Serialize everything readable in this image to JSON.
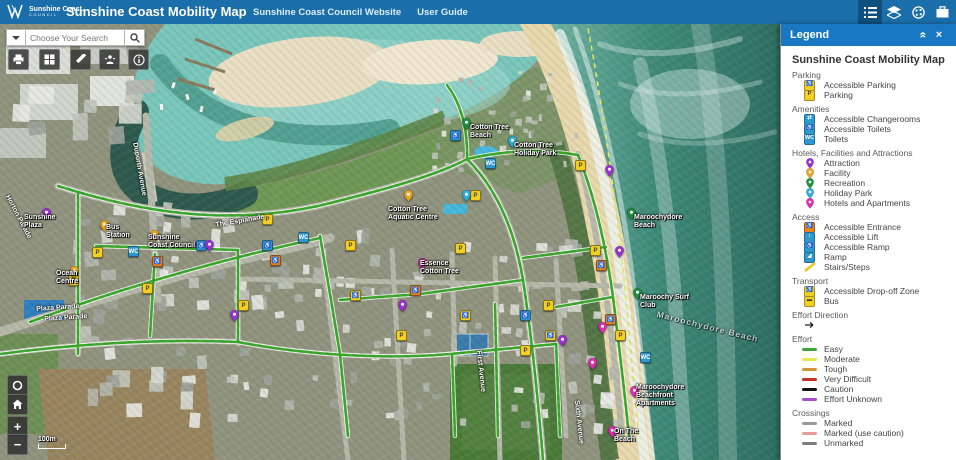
{
  "colors": {
    "header_bar": "#1a6ea9",
    "panel_header": "#1877c0",
    "path_green": "#3aa62b"
  },
  "header": {
    "logo": {
      "line1": "Sunshine Coast.",
      "line2": "COUNCIL"
    },
    "title": "Sunshine Coast Mobility Map",
    "links": [
      {
        "label": "Sunshine Coast Council Website"
      },
      {
        "label": "User Guide"
      }
    ],
    "tools": [
      {
        "name": "legend",
        "active": true
      },
      {
        "name": "layers",
        "active": false
      },
      {
        "name": "basemap",
        "active": false
      },
      {
        "name": "bookmarks",
        "active": false
      }
    ]
  },
  "search": {
    "placeholder": "Choose Your Search"
  },
  "map_tools": [
    {
      "name": "print"
    },
    {
      "name": "apps"
    },
    {
      "name": "draw"
    },
    {
      "name": "street-view"
    },
    {
      "name": "info"
    }
  ],
  "nav": {
    "zoom_in": "+",
    "zoom_out": "−",
    "scale_label": "100m"
  },
  "map": {
    "markers": [
      {
        "name": "parking-marker",
        "kind": "square",
        "color": "#f3cf1f",
        "glyph": "P",
        "glyph_color": "#3c3c3c",
        "points": [
          [
            68,
            251
          ],
          [
            92,
            223
          ],
          [
            142,
            259
          ],
          [
            238,
            276
          ],
          [
            262,
            190
          ],
          [
            345,
            216
          ],
          [
            396,
            306
          ],
          [
            455,
            219
          ],
          [
            470,
            166
          ],
          [
            520,
            321
          ],
          [
            543,
            276
          ],
          [
            575,
            136
          ],
          [
            590,
            221
          ],
          [
            615,
            306
          ]
        ]
      },
      {
        "name": "accessible-parking-marker",
        "kind": "square",
        "color": "#f3cf1f",
        "glyph": "♿",
        "glyph_color": "#1a4f9c",
        "points": [
          [
            350,
            266
          ],
          [
            460,
            286
          ],
          [
            545,
            306
          ]
        ]
      },
      {
        "name": "toilets-marker",
        "kind": "square",
        "color": "#2b98cf",
        "glyph": "WC",
        "glyph_color": "#ffffff",
        "points": [
          [
            128,
            222
          ],
          [
            298,
            208
          ],
          [
            485,
            134
          ],
          [
            640,
            328
          ]
        ]
      },
      {
        "name": "accessible-toilets-marker",
        "kind": "square",
        "color": "#2b98cf",
        "glyph": "♿",
        "glyph_color": "#ffffff",
        "points": [
          [
            196,
            216
          ],
          [
            450,
            106
          ],
          [
            520,
            286
          ],
          [
            262,
            216
          ]
        ]
      },
      {
        "name": "accessible-entrance-marker",
        "kind": "square",
        "color": "#e8821d",
        "glyph": "♿",
        "glyph_color": "#ffffff",
        "points": [
          [
            270,
            231
          ],
          [
            410,
            261
          ],
          [
            596,
            236
          ],
          [
            605,
            290
          ],
          [
            152,
            232
          ]
        ]
      },
      {
        "name": "attraction-marker",
        "kind": "pin",
        "color": "#9b30d0",
        "points": [
          [
            42,
            194
          ],
          [
            205,
            226
          ],
          [
            230,
            296
          ],
          [
            398,
            286
          ],
          [
            605,
            151
          ],
          [
            615,
            232
          ],
          [
            558,
            321
          ]
        ]
      },
      {
        "name": "hotels-marker",
        "kind": "pin",
        "color": "#df2bb0",
        "points": [
          [
            418,
            244
          ],
          [
            598,
            308
          ],
          [
            630,
            372
          ],
          [
            608,
            412
          ],
          [
            588,
            344
          ]
        ]
      },
      {
        "name": "recreation-marker",
        "kind": "pin",
        "color": "#1e8f41",
        "points": [
          [
            462,
            104
          ],
          [
            627,
            194
          ],
          [
            633,
            274
          ]
        ]
      },
      {
        "name": "holiday-park-marker",
        "kind": "pin",
        "color": "#2aaede",
        "points": [
          [
            508,
            122
          ],
          [
            462,
            176
          ]
        ]
      },
      {
        "name": "facility-marker",
        "kind": "pin",
        "color": "#e9a41f",
        "points": [
          [
            404,
            176
          ],
          [
            100,
            206
          ],
          [
            150,
            216
          ],
          [
            70,
            252
          ]
        ]
      }
    ],
    "labels": [
      {
        "text": "Cotton Tree Beach",
        "x": 470,
        "y": 100,
        "w": 48
      },
      {
        "text": "Cotton Tree Holiday Park",
        "x": 514,
        "y": 118,
        "w": 56
      },
      {
        "text": "Cotton Tree Aquatic Centre",
        "x": 388,
        "y": 182,
        "w": 58
      },
      {
        "text": "Maroochydore Beach",
        "x": 634,
        "y": 190,
        "w": 56
      },
      {
        "text": "Maroochy Surf Club",
        "x": 640,
        "y": 270,
        "w": 50
      },
      {
        "text": "Maroochydore Beach",
        "x": 658,
        "y": 286,
        "rot": 14,
        "faint": true,
        "w": 120
      },
      {
        "text": "Maroochydore Beachfront Apartments",
        "x": 636,
        "y": 360,
        "w": 62
      },
      {
        "text": "On The Beach",
        "x": 614,
        "y": 404,
        "w": 40
      },
      {
        "text": "Bus Station",
        "x": 106,
        "y": 200,
        "w": 34
      },
      {
        "text": "Sunshine Coast Council",
        "x": 148,
        "y": 210,
        "w": 52
      },
      {
        "text": "Sunshine Plaza",
        "x": 24,
        "y": 190,
        "w": 44
      },
      {
        "text": "Ocean Centre",
        "x": 56,
        "y": 246,
        "w": 40
      },
      {
        "text": "Essence Cotton Tree",
        "x": 420,
        "y": 236,
        "w": 46
      }
    ],
    "streets": [
      {
        "text": "Horton Parade",
        "x": 10,
        "y": 170,
        "rot": 62
      },
      {
        "text": "Duporth Avenue",
        "x": 138,
        "y": 118,
        "rot": 80
      },
      {
        "text": "The Esplanade",
        "x": 215,
        "y": 198,
        "rot": -10
      },
      {
        "text": "Plaza Parade",
        "x": 36,
        "y": 282,
        "rot": -4
      },
      {
        "text": "Plaza Parade",
        "x": 44,
        "y": 292,
        "rot": -4
      },
      {
        "text": "First Avenue",
        "x": 482,
        "y": 326,
        "rot": 84
      },
      {
        "text": "Sixth Avenue",
        "x": 580,
        "y": 376,
        "rot": 84
      }
    ]
  },
  "legend": {
    "title": "Legend",
    "map_title": "Sunshine Coast Mobility Map",
    "sections": [
      {
        "name": "Parking",
        "items": [
          {
            "label": "Accessible Parking",
            "type": "square",
            "color": "#f3cf1f",
            "glyph": "♿",
            "glyph_color": "#1a4f9c"
          },
          {
            "label": "Parking",
            "type": "square",
            "color": "#f3cf1f",
            "glyph": "P",
            "glyph_color": "#3c3c3c"
          }
        ]
      },
      {
        "name": "Amenities",
        "items": [
          {
            "label": "Accessible Changerooms",
            "type": "square",
            "color": "#2b98cf",
            "glyph": "⇄",
            "glyph_color": "#ffffff"
          },
          {
            "label": "Accessible Toilets",
            "type": "square",
            "color": "#2b98cf",
            "glyph": "♿",
            "glyph_color": "#ffffff"
          },
          {
            "label": "Toilets",
            "type": "square",
            "color": "#2b98cf",
            "glyph": "WC",
            "glyph_color": "#ffffff"
          }
        ]
      },
      {
        "name": "Hotels, Facilities and Attractions",
        "items": [
          {
            "label": "Attraction",
            "type": "pin",
            "color": "#9b30d0"
          },
          {
            "label": "Facility",
            "type": "pin",
            "color": "#e9a41f"
          },
          {
            "label": "Recreation",
            "type": "pin",
            "color": "#1e8f41"
          },
          {
            "label": "Holiday Park",
            "type": "pin",
            "color": "#2aaede"
          },
          {
            "label": "Hotels and Apartments",
            "type": "pin",
            "color": "#df2bb0"
          }
        ]
      },
      {
        "name": "Access",
        "items": [
          {
            "label": "Accessible Entrance",
            "type": "square",
            "color": "#e8821d",
            "glyph": "♿",
            "glyph_color": "#ffffff"
          },
          {
            "label": "Accessible Lift",
            "type": "square",
            "color": "#2b98cf",
            "glyph": "↕",
            "glyph_color": "#ffffff"
          },
          {
            "label": "Accessible Ramp",
            "type": "square",
            "color": "#2b98cf",
            "glyph": "♿",
            "glyph_color": "#ffffff"
          },
          {
            "label": "Ramp",
            "type": "square",
            "color": "#2b98cf",
            "glyph": "◢",
            "glyph_color": "#ffffff"
          },
          {
            "label": "Stairs/Steps",
            "type": "slash",
            "color": "#e8c61d"
          }
        ]
      },
      {
        "name": "Transport",
        "items": [
          {
            "label": "Accessible Drop-off Zone",
            "type": "square",
            "color": "#f3cf1f",
            "glyph": "♿",
            "glyph_color": "#3c3c3c"
          },
          {
            "label": "Bus",
            "type": "square",
            "color": "#f3cf1f",
            "glyph": "▬",
            "glyph_color": "#3c3c3c"
          }
        ]
      },
      {
        "name": "Effort Direction",
        "items": [
          {
            "label": "",
            "type": "arrow",
            "color": "#222222"
          }
        ]
      },
      {
        "name": "Effort",
        "items": [
          {
            "label": "Easy",
            "type": "line",
            "color": "#3fa33a"
          },
          {
            "label": "Moderate",
            "type": "line",
            "color": "#e6e64e"
          },
          {
            "label": "Tough",
            "type": "line",
            "color": "#d3923c"
          },
          {
            "label": "Very Difficult",
            "type": "line",
            "color": "#c23227"
          },
          {
            "label": "Caution",
            "type": "line",
            "color": "#111111"
          },
          {
            "label": "Effort Unknown",
            "type": "line",
            "color": "#a44fd0"
          }
        ]
      },
      {
        "name": "Crossings",
        "items": [
          {
            "label": "Marked",
            "type": "line",
            "color": "#999999"
          },
          {
            "label": "Marked (use caution)",
            "type": "line",
            "color": "#e79c9c"
          },
          {
            "label": "Unmarked",
            "type": "line",
            "color": "#7d7d7d"
          }
        ]
      }
    ]
  }
}
